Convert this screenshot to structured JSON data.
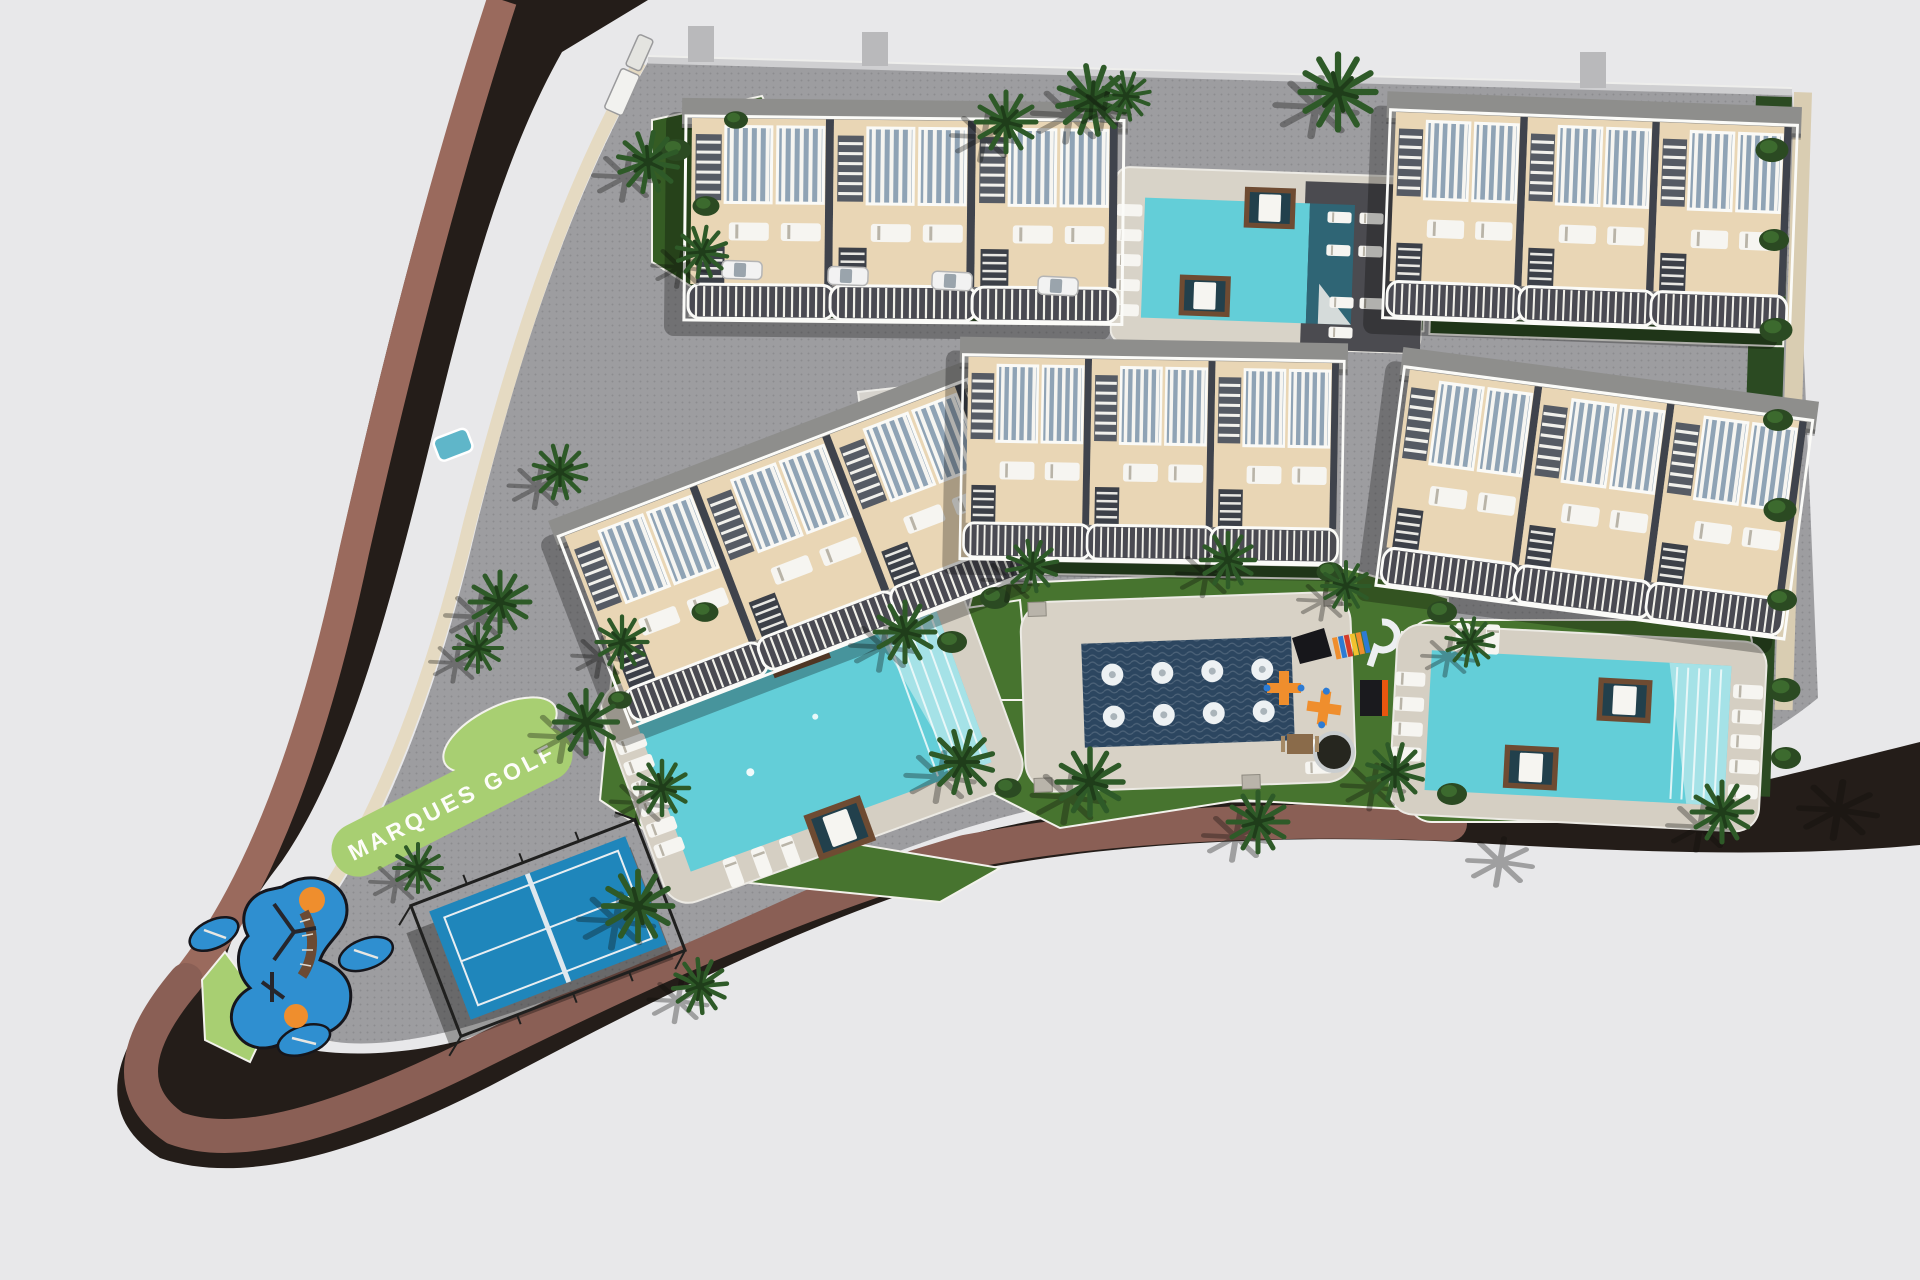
{
  "scene": {
    "type": "aerial-3d-site-plan-render",
    "label": "MARQUES GOLF"
  },
  "signage": {
    "road_text": "MARQUES GOLF"
  },
  "colors": {
    "background": "#e8e8ea",
    "asphalt": "#241d19",
    "brick_left": "#9a6a5d",
    "brick_road": "#8a5f55",
    "sidewalk_cream": "#e5dac2",
    "paving_gray": "#9d9da0",
    "lawn": "#47742f",
    "lawn_dark": "#355c24",
    "lawn_lime": "#a8cf72",
    "hedge": "#2b4a22",
    "palm": "#2e5a28",
    "palm_dark": "#1f3d1a",
    "pool_water": "#63ced8",
    "pool_steps": "#a9e3e8",
    "pool_dark": "#2f6575",
    "deck_beige": "#d5cfc3",
    "deck_dark": "#4b4b50",
    "splash_navy": "#2c4660",
    "jet_white": "#edf1f3",
    "building_terrace": "#e9d6b5",
    "building_white": "#f7f6f2",
    "building_roof": "#8e8e8c",
    "building_void": "#3f434c",
    "pergola_blue": "#8fa3b5",
    "lounger": "#f6f5f1",
    "daybed_wood": "#6e4b32",
    "daybed_dark": "#22404c",
    "court_blue": "#1f86bb",
    "cage_dark": "#20201f",
    "rubber_blue": "#2f8fd0",
    "play_orange": "#ef8e2d",
    "car_white": "#f2f2f2",
    "kerb_white": "#f3f2ec",
    "concrete_pad": "#d8d2c6",
    "wall_sand": "#d9cdb2"
  },
  "features": {
    "residential_blocks": 5,
    "swimming_pools": 3,
    "splash_pad_jets": 8,
    "paddle_courts": 1,
    "children_playgrounds": 2,
    "parked_cars": 4
  }
}
